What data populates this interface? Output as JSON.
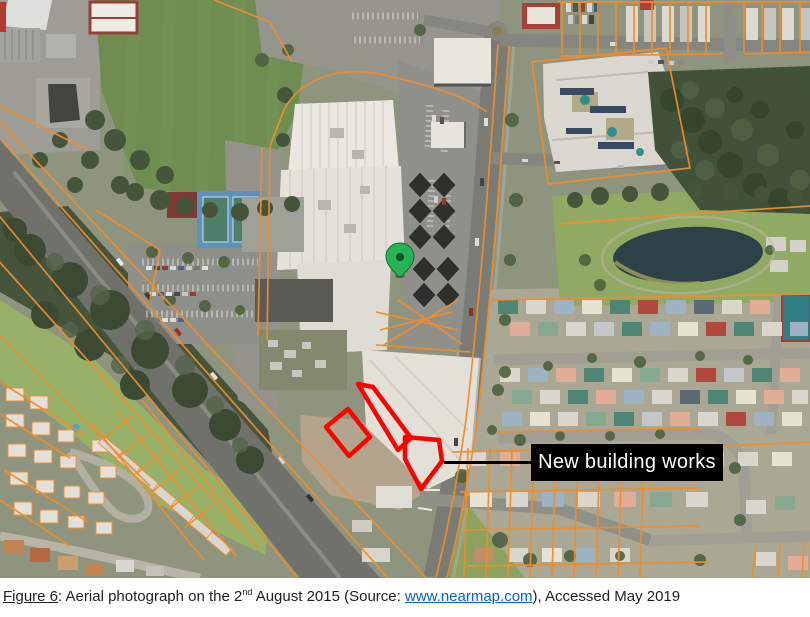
{
  "theme": {
    "annotation_red": "#ff0000",
    "cadastral_orange": "#ef8d2d",
    "label_bg": "#000000",
    "label_text": "#ffffff",
    "pin_green": "#27b357",
    "link_color": "#0563c1"
  },
  "figure": {
    "annotation": {
      "label": "New building works"
    },
    "marker": {
      "name": "location-pin",
      "color": "#27b357"
    }
  },
  "caption": {
    "figure_label": "Figure 6",
    "separator": ": ",
    "text_before_superscript": "Aerial photograph on the 2",
    "superscript": "nd",
    "text_after_superscript": " August 2015 (Source: ",
    "link_text": "www.nearmap.com",
    "text_after_link": "), Accessed May 2019"
  }
}
